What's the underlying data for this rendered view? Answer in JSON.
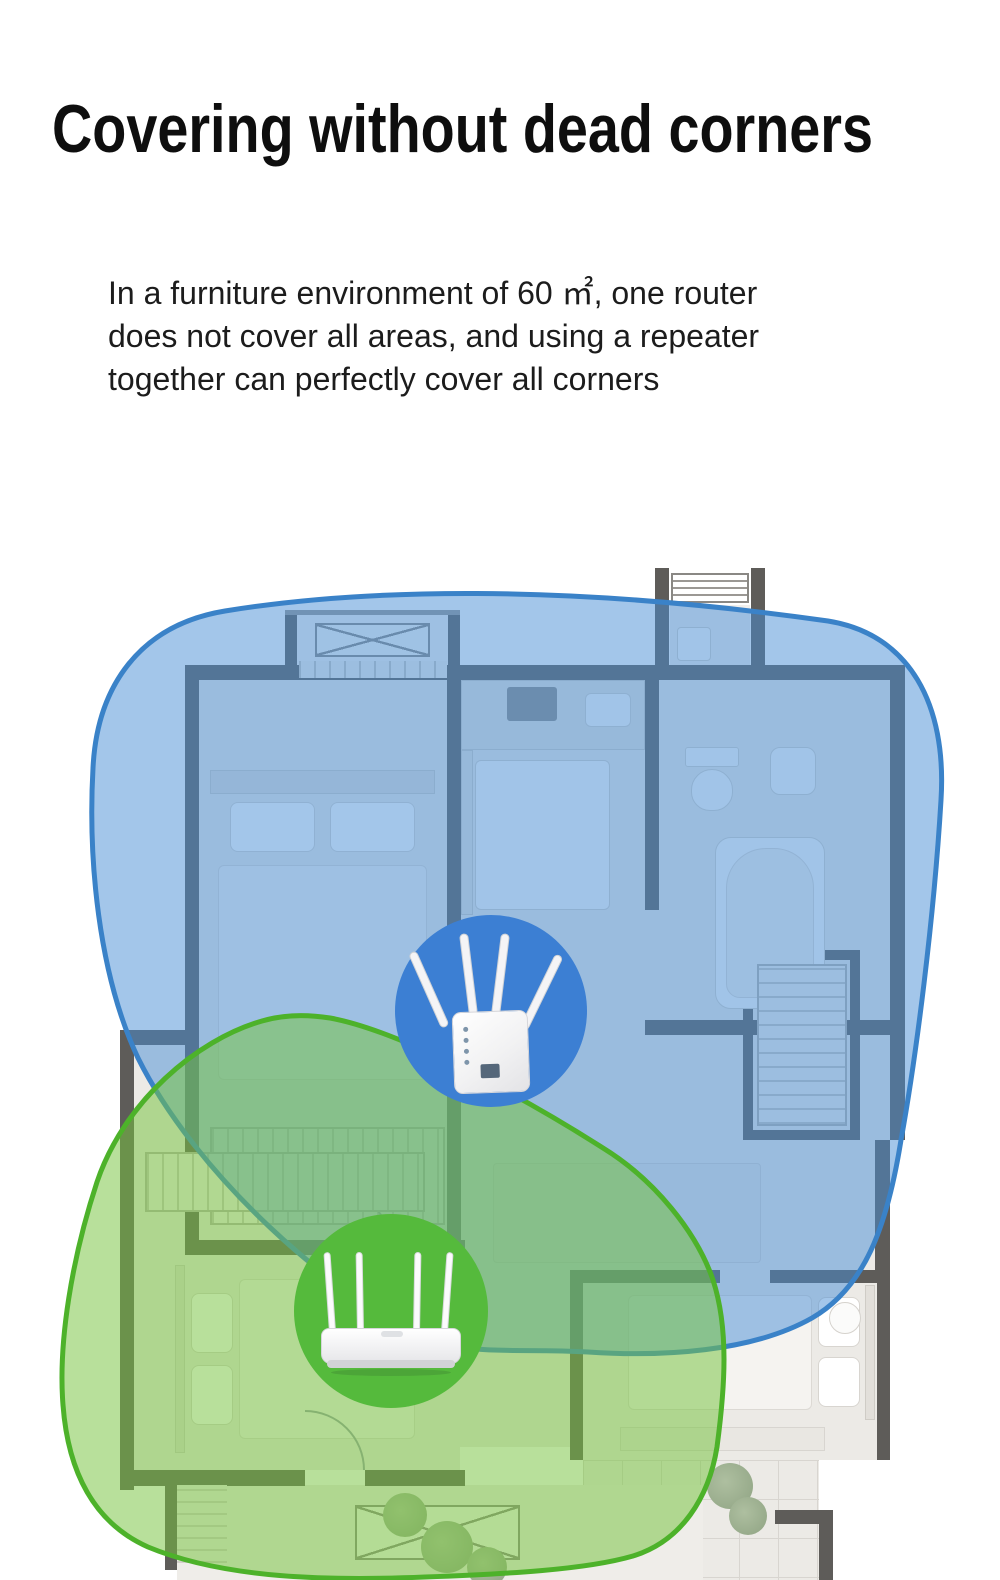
{
  "header": {
    "title": "Covering without dead corners",
    "description": "In a furniture environment of 60 ㎡, one router\ndoes not cover all areas, and using a repeater\ntogether can perfectly cover all corners"
  },
  "diagram": {
    "repeater": {
      "icon": "wifi-repeater-icon",
      "coverage": "blue"
    },
    "router": {
      "icon": "wifi-router-icon",
      "coverage": "green"
    }
  },
  "colors": {
    "blue_coverage_fill": "rgba(72,142,214,0.50)",
    "blue_coverage_stroke": "#3a82c8",
    "green_coverage_fill": "rgba(118,195,64,0.52)",
    "green_coverage_stroke": "#4db22a",
    "repeater_circle_color": "#3c7fd3",
    "router_circle_color": "#55ba3c",
    "title_color": "#0e0e0e",
    "body_color": "#1c1c1c"
  }
}
